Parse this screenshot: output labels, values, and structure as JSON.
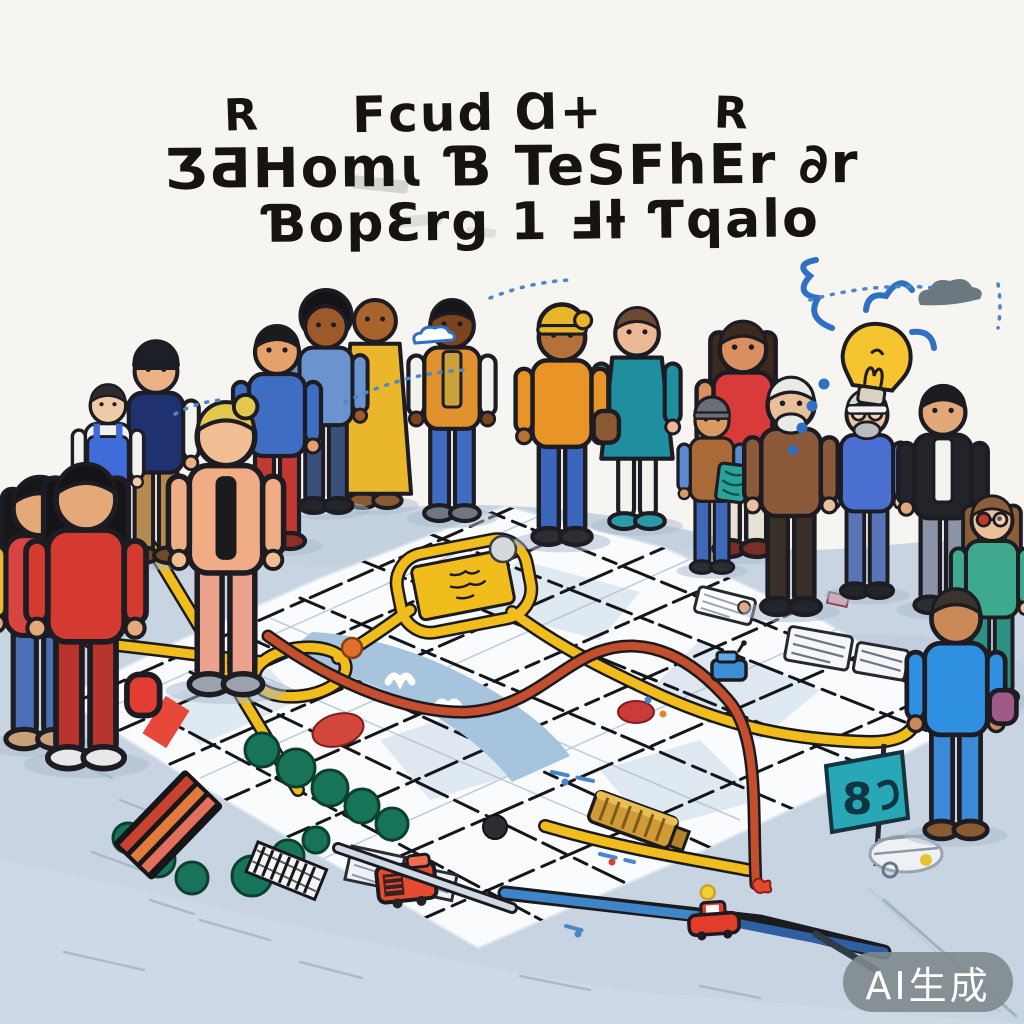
{
  "title": {
    "line1_left": "R",
    "line1_center": "Fcud Ɑ+",
    "line1_right": "R",
    "line2": "ƷƋHomɩ Ɓ TeSFhEr ∂r",
    "line3": "ƁopƐrg 1 Ⅎƚ Ƭqalo",
    "color": "#17140f"
  },
  "watermark": {
    "text": "AI生成",
    "bg": "rgba(125,137,141,0.9)",
    "fg": "#ffffff"
  },
  "map": {
    "flag_glyph": "8"
  },
  "palette": {
    "background": "#f6f5f2",
    "ink": "#1c1c22",
    "ground": "#c9d4e2",
    "ground_shade": "#b9c7d8",
    "map_white": "#f9fbfd",
    "block_shade": "#dbe5ef",
    "road_yellow": "#f0bd1c",
    "road_red": "#c44f2e",
    "river_blue": "#a6c4de",
    "tree_green": "#187458",
    "awning_1": "#c8432f",
    "awning_2": "#e07b3c",
    "awning_3": "#e2705a",
    "truck_red": "#e64a33",
    "car_red": "#e33c2a",
    "train_gold": "#d09a36",
    "piece_blue": "#3e8ed6",
    "flag_teal": "#28a7b6",
    "bulb_yellow": "#f5c42e",
    "doodle_blue": "#2f6fc4",
    "dash_blue": "#4a86cc",
    "red_block": "#e8483a",
    "cloud_gray": "#5d6a73"
  },
  "icons": [
    "lightbulb-icon",
    "idea-scribble-icon",
    "cloud-icon",
    "speech-dashes-icon",
    "city-map",
    "river",
    "tree-row",
    "striped-awning",
    "red-truck",
    "red-car",
    "gold-train",
    "blue-game-piece",
    "teal-flag",
    "white-parcel",
    "sketch-train"
  ],
  "people": [
    {
      "id": "girl-back-left",
      "x": 40,
      "y": 482,
      "h": 268,
      "skin": "#e5a878",
      "hair": "#17171a",
      "hairstyle": "long",
      "top": "#d84540",
      "sleeves": "#e8b832",
      "bottom": "#4a6fb5",
      "shoes": "#c9a27a",
      "back": true
    },
    {
      "id": "girl-back-red-coat",
      "x": 86,
      "y": 470,
      "h": 300,
      "skin": "#e5a878",
      "hair": "#141418",
      "hairstyle": "long",
      "top": "#d53a30",
      "bottom": "#b8332c",
      "shoes": "#e8e8e8",
      "back": true,
      "bag": "#e23d33",
      "bagY": 150
    },
    {
      "id": "pinafore-elder",
      "x": 108,
      "y": 388,
      "h": 178,
      "skin": "#f0c9a6",
      "hair": "#2b2b30",
      "hairstyle": "short",
      "top": "#f2f2ef",
      "vest": "#3f6cd8",
      "bottom": "#7a87a0",
      "shoes": "#3a3d44"
    },
    {
      "id": "beanie-man",
      "x": 156,
      "y": 350,
      "h": 214,
      "skin": "#e9b184",
      "hair": "#222222",
      "hairstyle": "beanie",
      "hat": "#1d1f29",
      "top": "#20316f",
      "sleeves": "#f2f2ef",
      "bottom": "#b58a52",
      "shoes": "#6e4a26"
    },
    {
      "id": "peach-back",
      "x": 226,
      "y": 408,
      "h": 288,
      "skin": "#f2bd93",
      "hair": "#e3c84e",
      "hairstyle": "bun",
      "top": "#f0ad85",
      "bottom": "#eda28e",
      "shoes": "#9aa3ad",
      "back": true,
      "stripe": "#1b1b1e"
    },
    {
      "id": "kid-blue-red",
      "x": 277,
      "y": 330,
      "h": 220,
      "skin": "#e5a06b",
      "hair": "#1a1a1e",
      "hairstyle": "short",
      "top": "#3e6dc2",
      "bottom": "#c03a33",
      "shoes": "#8c2f2a"
    },
    {
      "id": "afro-blue",
      "x": 326,
      "y": 306,
      "h": 208,
      "skin": "#9c5a2b",
      "hair": "#131318",
      "hairstyle": "afro",
      "top": "#6a93cf",
      "bottom": "#39507a",
      "shoes": "#23252b"
    },
    {
      "id": "robe-man",
      "x": 375,
      "y": 300,
      "h": 209,
      "skin": "#a9642e",
      "hair": "#a9642e",
      "hairstyle": "bald",
      "top": "#eab62c",
      "bottom": "#eab62c",
      "shoes": "#8a5a32",
      "kind": "robe"
    },
    {
      "id": "dashiki-man",
      "x": 452,
      "y": 304,
      "h": 218,
      "skin": "#7c441d",
      "hair": "#15151a",
      "hairstyle": "short",
      "top": "#e0922f",
      "scarf": "#caa23a",
      "sleeves": "#f2f2ef",
      "bottom": "#3f6cc0",
      "shoes": "#6f7680"
    },
    {
      "id": "orange-man",
      "x": 562,
      "y": 314,
      "h": 232,
      "skin": "#b4713a",
      "hair": "#2a2118",
      "hairstyle": "wrap",
      "hat": "#e8b62b",
      "top": "#e89427",
      "bottom": "#3a66bb",
      "shoes": "#2c2e33",
      "bag": "#8a5a32",
      "bagY": 92
    },
    {
      "id": "teal-dress-woman",
      "x": 637,
      "y": 312,
      "h": 218,
      "skin": "#edb894",
      "hair": "#6c4a32",
      "hairstyle": "short",
      "top": "#1f8fa0",
      "bottom": "#f2f2ef",
      "shoes": "#2a9aa8",
      "kind": "dress"
    },
    {
      "id": "kid-drawing",
      "x": 712,
      "y": 404,
      "h": 170,
      "skin": "#d99a62",
      "hair": "#5a5c63",
      "hairstyle": "beanie",
      "hat": "#6b6e76",
      "top": "#a96a38",
      "sleeves": "#5b8ad0",
      "bottom": "#3f68b8",
      "shoes": "#2c2e33",
      "board": "#2aa39a"
    },
    {
      "id": "red-top-woman",
      "x": 743,
      "y": 326,
      "h": 232,
      "skin": "#d98f5f",
      "hair": "#3d2a1e",
      "hairstyle": "long",
      "top": "#d93a3a",
      "sleeves": "#d98f5f",
      "bottom": "#e8e2d4",
      "shoes": "#7a2e28"
    },
    {
      "id": "elder-beard",
      "x": 791,
      "y": 382,
      "h": 234,
      "skin": "#e8c09c",
      "hair": "#e9e9e6",
      "hairstyle": "short",
      "beard": "#e9e9e6",
      "top": "#8a5a3a",
      "bottom": "#3a3028",
      "shoes": "#23252b"
    },
    {
      "id": "bulb-man",
      "x": 867,
      "y": 394,
      "h": 205,
      "skin": "#ecc6a4",
      "hair": "#d8d8d4",
      "hairstyle": "band",
      "band": "#f2f2f0",
      "beard": "#b9bcbd",
      "glasses": true,
      "top": "#4a6fd0",
      "bottom": "#5a74b8",
      "shoes": "#23252b"
    },
    {
      "id": "dark-jacket-man",
      "x": 943,
      "y": 390,
      "h": 224,
      "skin": "#e2a878",
      "hair": "#1c1c20",
      "hairstyle": "short",
      "top": "#23242a",
      "shirt": "#f2f2ef",
      "bottom": "#8c93a6",
      "shoes": "#2c2e33"
    },
    {
      "id": "glasses-woman",
      "x": 992,
      "y": 500,
      "h": 205,
      "skin": "#eec09a",
      "hair": "#8a5f38",
      "hairstyle": "long",
      "glasses": true,
      "lens": "#c0392b",
      "top": "#3fa98e",
      "sleeves": "#3fa98e",
      "bottom": "#2f8f80",
      "shoes": "#555555"
    },
    {
      "id": "blue-back-man",
      "x": 956,
      "y": 594,
      "h": 246,
      "skin": "#c98a58",
      "hair": "#3a342c",
      "hairstyle": "short",
      "top": "#2f8fe0",
      "bottom": "#3a8ad8",
      "shoes": "#8a5a32",
      "back": true,
      "bag": "#a05a88"
    }
  ]
}
